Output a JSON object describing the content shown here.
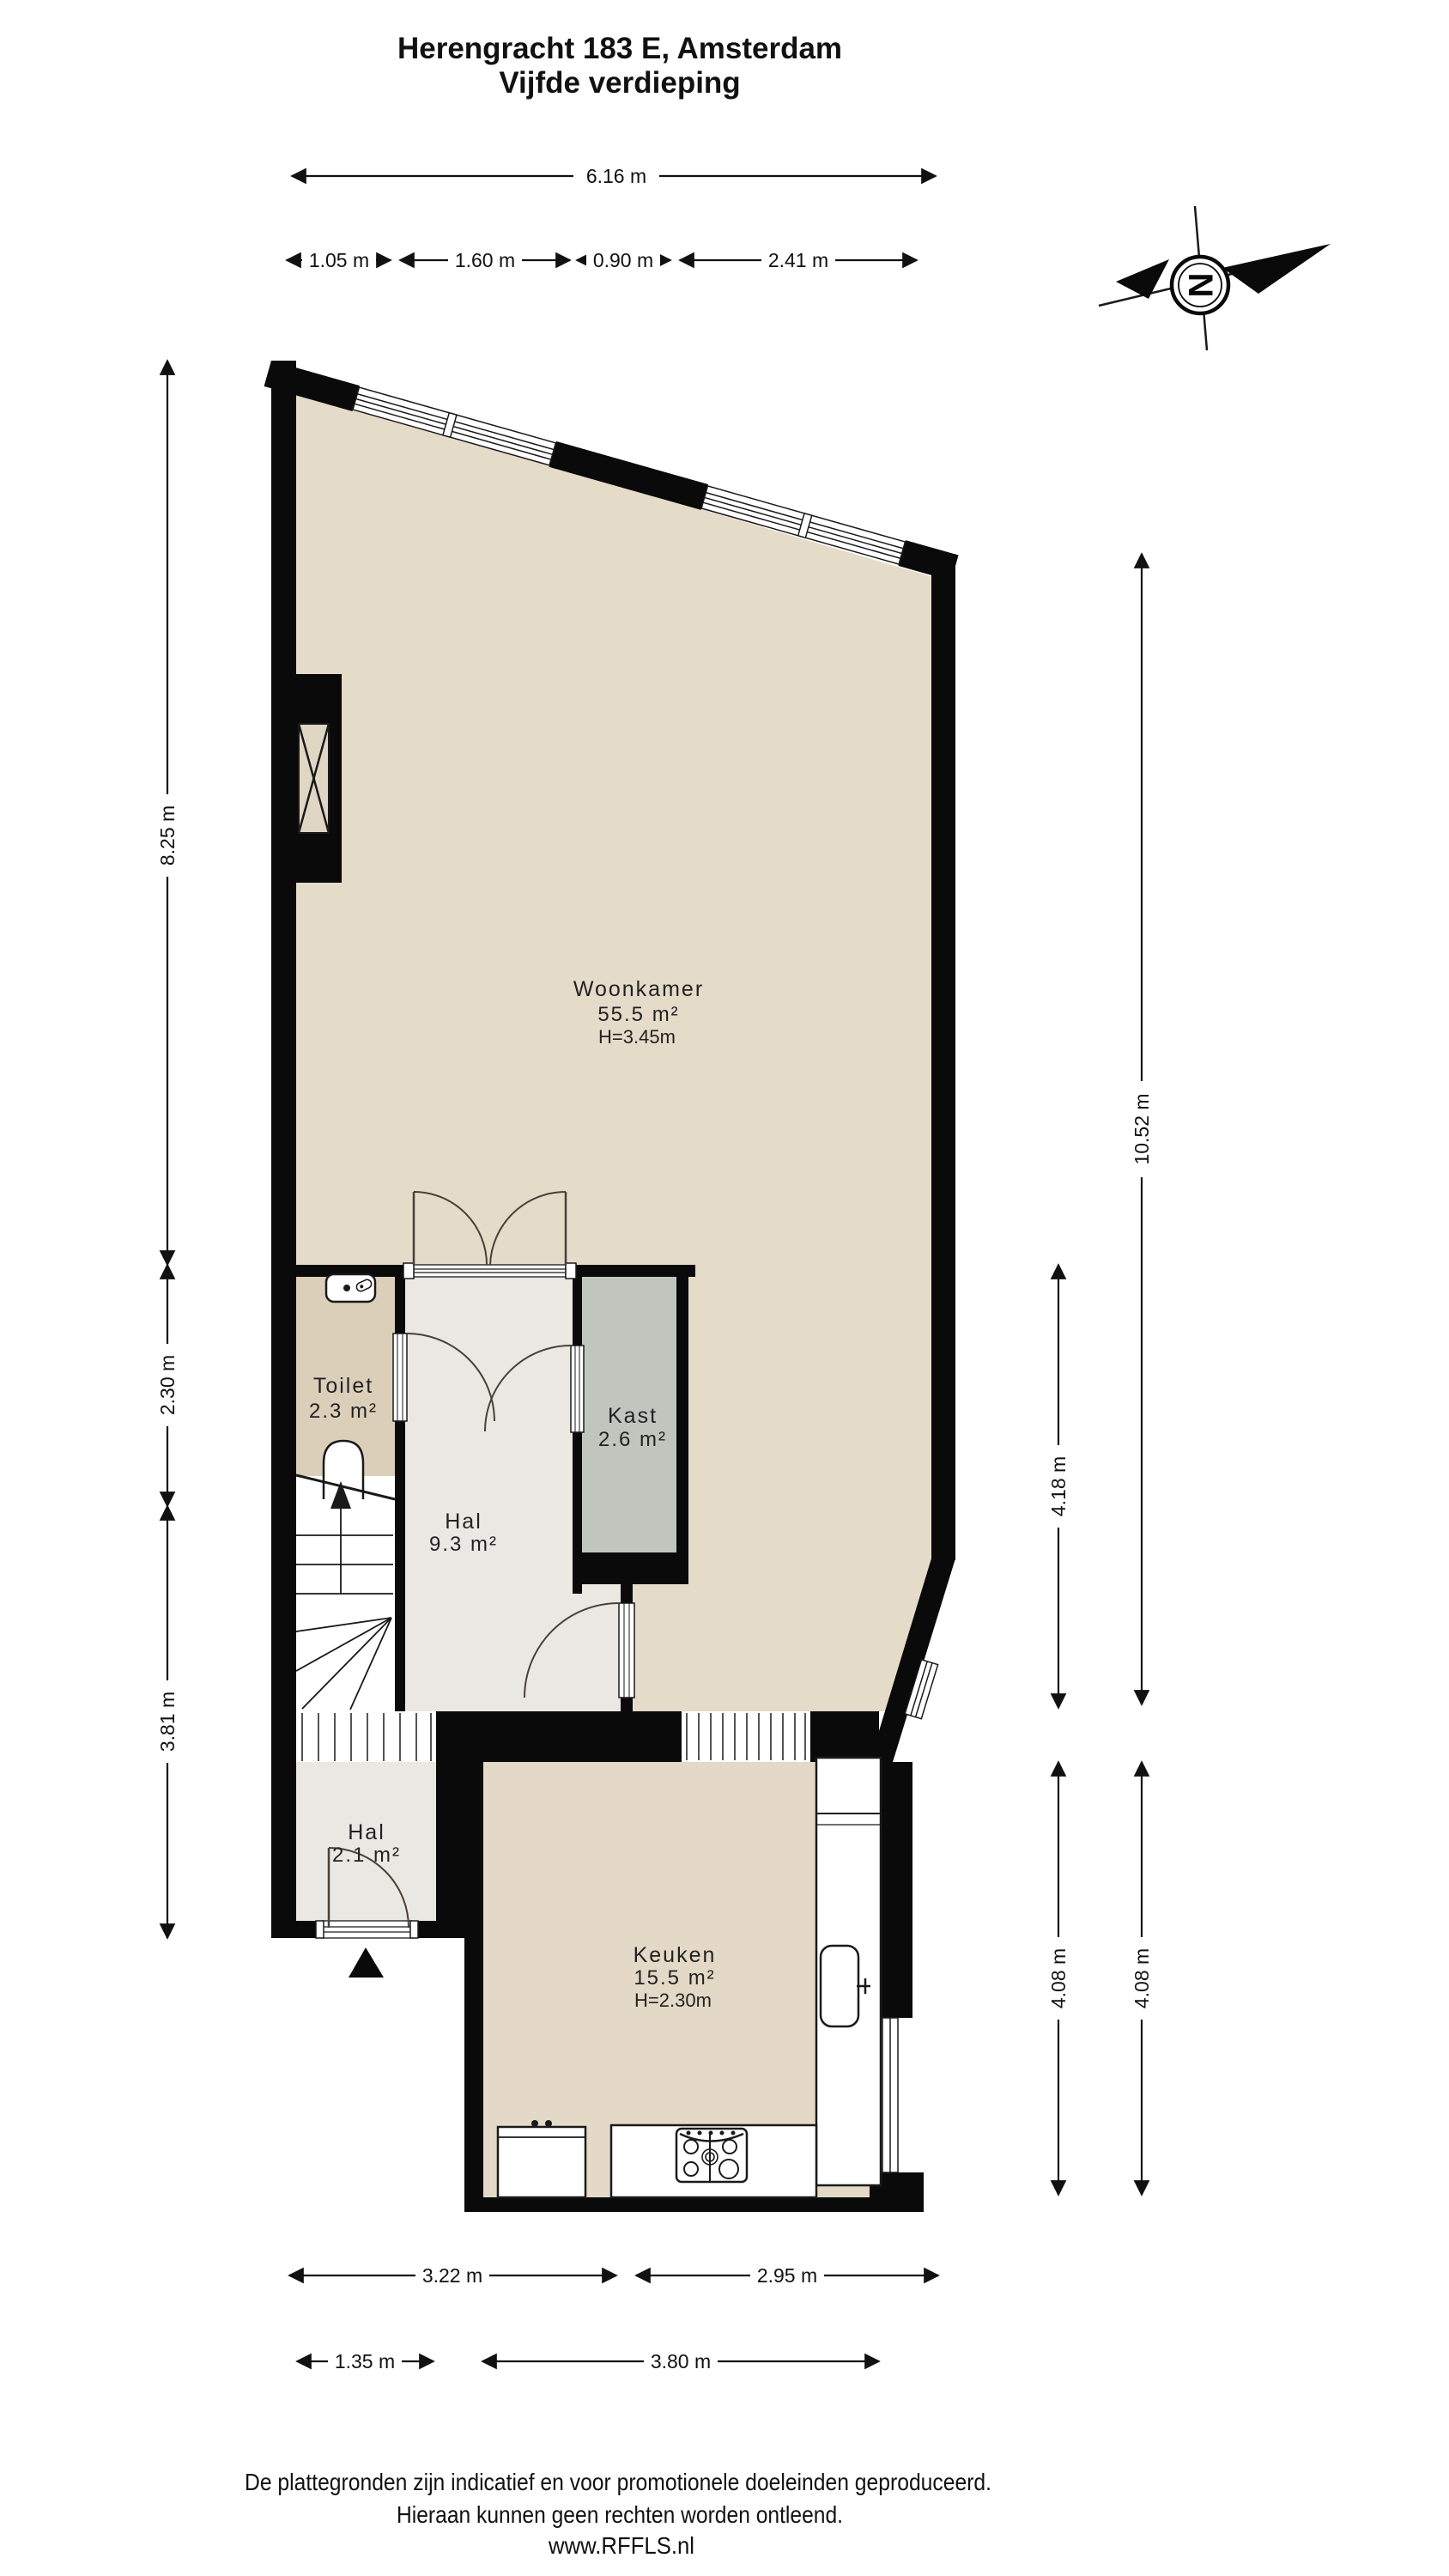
{
  "title": {
    "line1": "Herengracht 183 E, Amsterdam",
    "line2": "Vijfde verdieping"
  },
  "compass": {
    "north_letter": "N"
  },
  "rooms": {
    "woonkamer": {
      "name": "Woonkamer",
      "area": "55.5 m²",
      "height": "H=3.45m"
    },
    "toilet": {
      "name": "Toilet",
      "area": "2.3 m²"
    },
    "hal": {
      "name": "Hal",
      "area": "9.3 m²"
    },
    "kast": {
      "name": "Kast",
      "area": "2.6 m²"
    },
    "hal2": {
      "name": "Hal",
      "area": "2.1 m²"
    },
    "keuken": {
      "name": "Keuken",
      "area": "15.5 m²",
      "height": "H=2.30m"
    }
  },
  "dimensions": {
    "top_total": "6.16 m",
    "top_segments": [
      "1.05 m",
      "1.60 m",
      "0.90 m",
      "2.41 m"
    ],
    "left": [
      "8.25 m",
      "2.30 m",
      "3.81 m"
    ],
    "right_outer": [
      "10.52 m",
      "4.08 m"
    ],
    "right_inner": [
      "4.18 m",
      "4.08 m"
    ],
    "bottom_upper": [
      "3.22 m",
      "2.95 m"
    ],
    "bottom_lower": [
      "1.35 m",
      "3.80 m"
    ]
  },
  "footer": {
    "line1": "De plattegronden zijn indicatief en voor promotionele doeleinden geproduceerd.",
    "line2": "Hieraan kunnen geen rechten worden ontleend.",
    "line3": "www.RFFLS.nl"
  },
  "colors": {
    "floor_living": "#e5dbc9",
    "floor_toilet": "#dbcfba",
    "floor_hall": "#eae8e2",
    "closet_grey": "#c0c6be",
    "wall": "#0a0a0a"
  }
}
